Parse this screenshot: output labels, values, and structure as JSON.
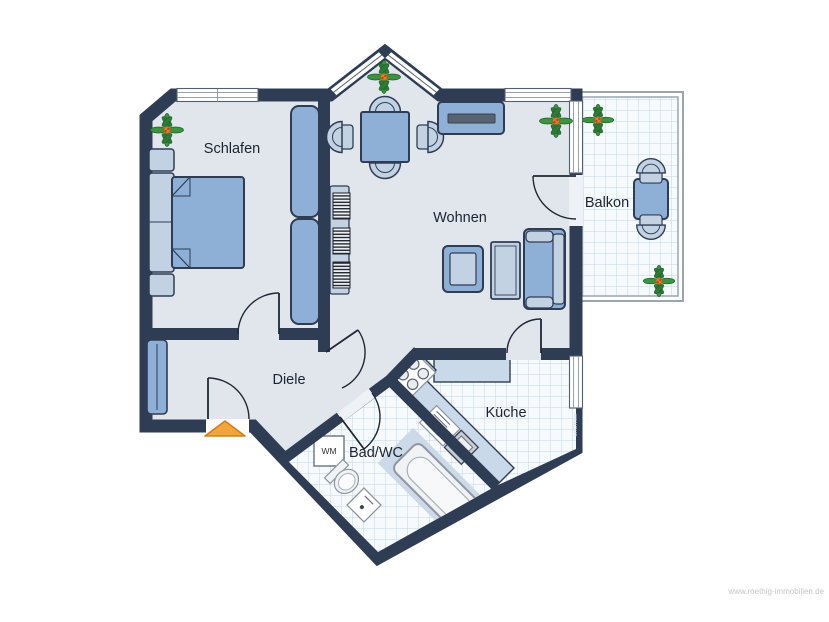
{
  "plan": {
    "rooms": {
      "schlafen": {
        "label": "Schlafen"
      },
      "wohnen": {
        "label": "Wohnen"
      },
      "balkon": {
        "label": "Balkon"
      },
      "diele": {
        "label": "Diele"
      },
      "kueche": {
        "label": "Küche"
      },
      "bad_wc": {
        "label": "Bad/WC"
      }
    },
    "appliances": {
      "washing_machine_label": "WM"
    },
    "furniture": {
      "schlafen": [
        "double-bed",
        "nightstand",
        "nightstand",
        "wardrobe",
        "wardrobe",
        "plant"
      ],
      "wohnen": [
        "dining-table",
        "four-chairs",
        "sideboard-with-tv",
        "radiator-shelf",
        "armchair",
        "coffee-table",
        "sofa",
        "plant"
      ],
      "balkon": [
        "bistro-table",
        "two-chairs",
        "plant",
        "plant"
      ],
      "diele": [
        "closet"
      ],
      "kueche": [
        "l-counter",
        "stove",
        "sink"
      ],
      "bad_wc": [
        "washing-machine",
        "toilet",
        "washbasin",
        "bathtub"
      ]
    }
  },
  "watermarks": {
    "agency_website": "www.roethig-immobilien.de",
    "software_brand": "onOffice"
  },
  "colors": {
    "wall": "#2e3d54",
    "floor": "#e1e6ec",
    "furn": "#8fb0d6",
    "furnlight": "#c3d2e3",
    "counter": "#c9d9ea",
    "tilebg": "#f7fafc",
    "tileline": "#c2d6e5",
    "accent": "#f2a53a",
    "accentborder": "#cf7e1e",
    "plantgreen": "#3a9440",
    "plantdark": "#1c5f24",
    "railing": "#9aa5b0",
    "tvbar": "#596270",
    "windowline": "#55606e",
    "labelink": "#1c2430",
    "watermark": "#c6c6c6",
    "brandink": "#d4dae2"
  }
}
